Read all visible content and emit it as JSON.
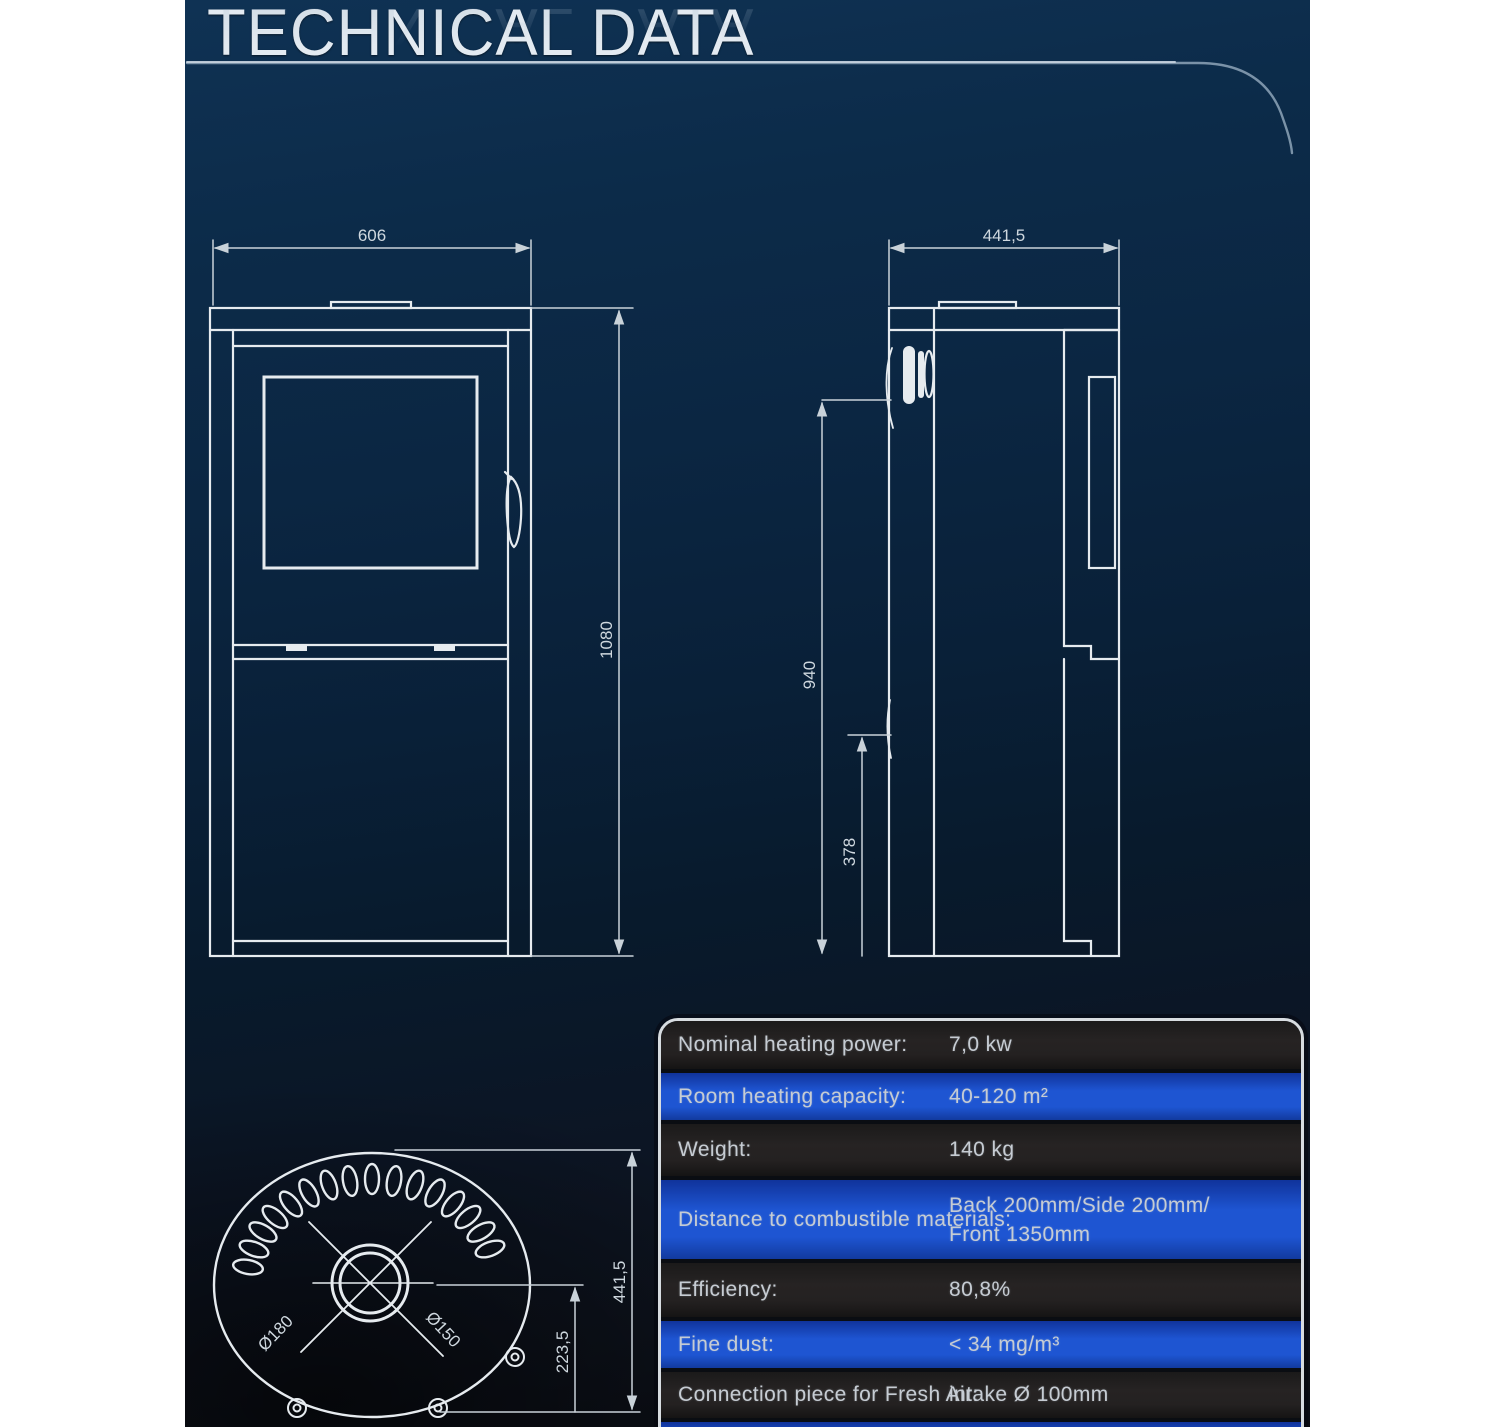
{
  "page": {
    "title": "TECHNICAL DATA"
  },
  "drawings": {
    "front_view": {
      "width_label": "606",
      "height_label": "1080"
    },
    "side_view": {
      "depth_label": "441,5",
      "flue_height_label": "940",
      "lower_height_label": "378"
    },
    "top_view": {
      "depth_label": "441,5",
      "center_offset_label": "223,5",
      "outer_flue_diameter_label": "Ø180",
      "inner_flue_diameter_label": "Ø150"
    }
  },
  "spec_table": {
    "rows": [
      {
        "label": "Nominal heating power:",
        "value": "7,0 kw"
      },
      {
        "label": "Room heating capacity:",
        "value": "40-120 m²"
      },
      {
        "label": "Weight:",
        "value": "140 kg"
      },
      {
        "label": "Distance to combustible materials:",
        "value": "Back 200mm/Side 200mm/",
        "value2": "Front 1350mm"
      },
      {
        "label": "Efficiency:",
        "value": "80,8%"
      },
      {
        "label": "Fine dust:",
        "value": "< 34 mg/m³"
      },
      {
        "label": "Connection piece for Fresh Air:",
        "value": "intake Ø 100mm"
      }
    ]
  },
  "colors": {
    "background_top": "#0f3254",
    "background_bottom": "#0a0c12",
    "row_blue": "#1e55d2",
    "row_dark": "#242121",
    "line_color": "#e6ebef",
    "table_border": "#d7dce0"
  }
}
